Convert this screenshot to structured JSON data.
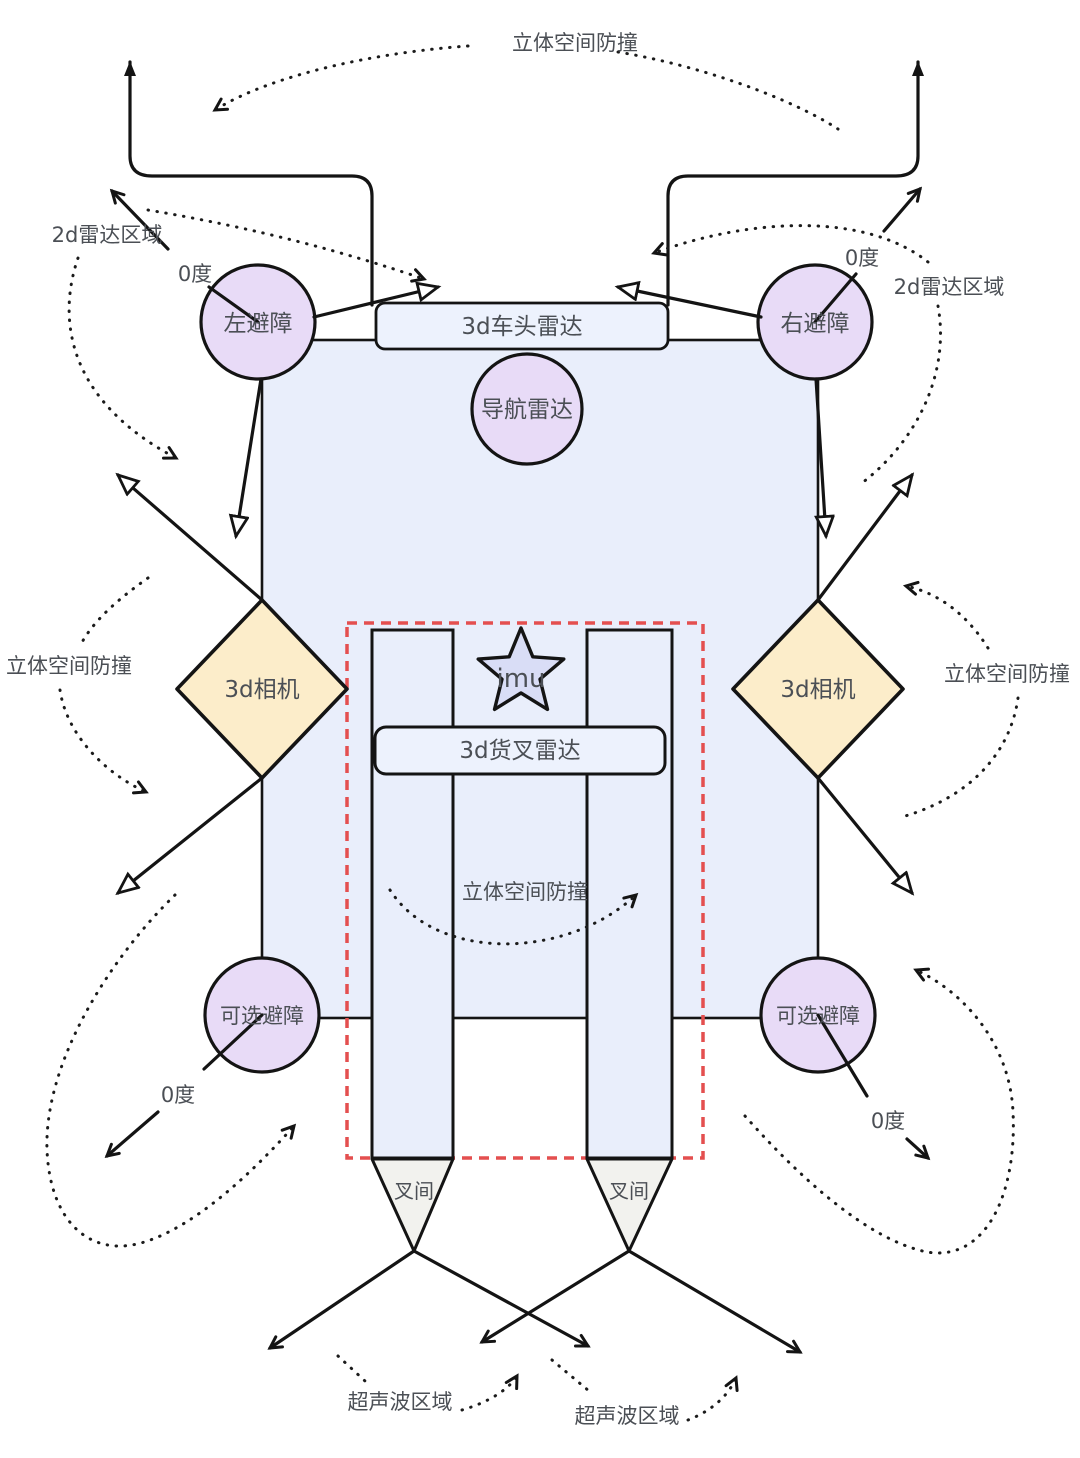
{
  "labels": {
    "stereo_collision_top": "立体空间防撞",
    "stereo_collision_left": "立体空间防撞",
    "stereo_collision_right": "立体空间防撞",
    "stereo_collision_center": "立体空间防撞",
    "radar2d_left": "2d雷达区域",
    "radar2d_right": "2d雷达区域",
    "zero_deg_top_left": "0度",
    "zero_deg_top_right": "0度",
    "zero_deg_bottom_left": "0度",
    "zero_deg_bottom_right": "0度",
    "avoid_left": "左避障",
    "avoid_right": "右避障",
    "front_radar": "3d车头雷达",
    "nav_radar": "导航雷达",
    "camera_left": "3d相机",
    "camera_right": "3d相机",
    "imu": "imu",
    "fork_radar": "3d货叉雷达",
    "optional_avoid_left": "可选避障",
    "optional_avoid_right": "可选避障",
    "fork_gap_left": "叉间",
    "fork_gap_right": "叉间",
    "ultrasonic_left": "超声波区域",
    "ultrasonic_right": "超声波区域"
  },
  "colors": {
    "sensor_purple": "#e8dbf7",
    "vehicle_body_blue": "#e9eefb",
    "radar_box_blue": "#edf2fd",
    "camera_yellow": "#fcedca",
    "imu_star_blue": "#d9ddf6",
    "fork_gap_gray": "#f2f2ee",
    "highlight_red_dashed": "#e44f4f",
    "line_black": "#141414",
    "text_gray": "#4b4f55"
  }
}
